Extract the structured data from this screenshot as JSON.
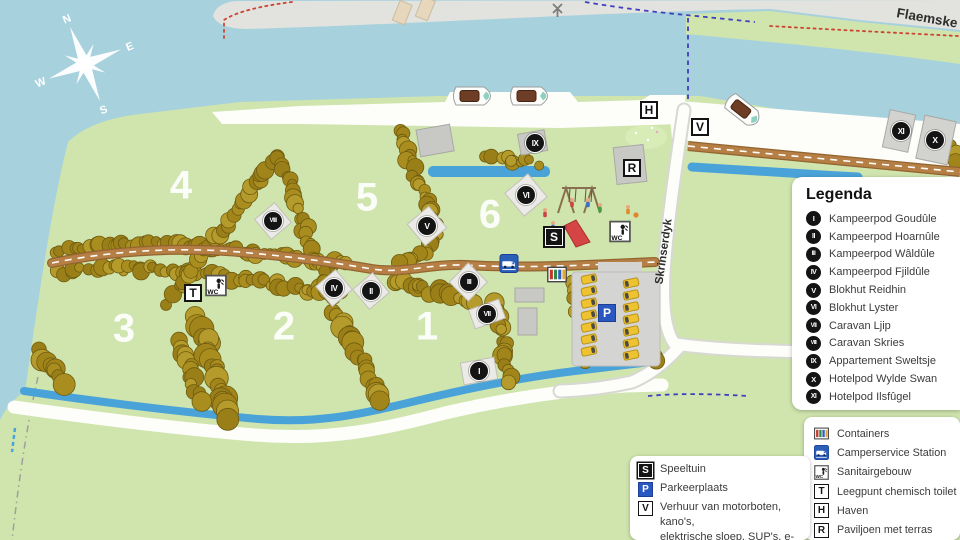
{
  "map": {
    "compass": {
      "n": "N",
      "e": "E",
      "s": "S",
      "w": "W"
    },
    "road_labels": [
      {
        "text": "Flaemske",
        "x": 896,
        "y": 17,
        "rot": 10,
        "anchor": "start",
        "size": 13.5
      },
      {
        "text": "Skrinserdyk",
        "x": 667,
        "y": 252,
        "rot": -82,
        "anchor": "middle",
        "size": 11.5
      }
    ],
    "zones": [
      {
        "label": "4",
        "x": 181,
        "y": 186
      },
      {
        "label": "5",
        "x": 367,
        "y": 198
      },
      {
        "label": "6",
        "x": 490,
        "y": 215
      },
      {
        "label": "3",
        "x": 124,
        "y": 329
      },
      {
        "label": "2",
        "x": 284,
        "y": 327
      },
      {
        "label": "1",
        "x": 427,
        "y": 327
      }
    ],
    "circle_markers": [
      {
        "numeral": "I",
        "x": 479,
        "y": 371
      },
      {
        "numeral": "II",
        "x": 371,
        "y": 291
      },
      {
        "numeral": "III",
        "x": 469,
        "y": 282
      },
      {
        "numeral": "IV",
        "x": 334,
        "y": 288
      },
      {
        "numeral": "V",
        "x": 427,
        "y": 226
      },
      {
        "numeral": "VI",
        "x": 526,
        "y": 195
      },
      {
        "numeral": "VII",
        "x": 487,
        "y": 314
      },
      {
        "numeral": "VIII",
        "x": 273,
        "y": 221
      },
      {
        "numeral": "IX",
        "x": 535,
        "y": 143
      },
      {
        "numeral": "X",
        "x": 935,
        "y": 140
      },
      {
        "numeral": "XI",
        "x": 901,
        "y": 131
      }
    ],
    "square_markers": [
      {
        "letter": "T",
        "x": 193,
        "y": 293,
        "style": "white"
      },
      {
        "letter": "S",
        "x": 554,
        "y": 237,
        "style": "black"
      },
      {
        "letter": "P",
        "x": 607,
        "y": 313,
        "style": "blue"
      },
      {
        "letter": "V",
        "x": 700,
        "y": 127,
        "style": "white"
      },
      {
        "letter": "H",
        "x": 649,
        "y": 110,
        "style": "white"
      },
      {
        "letter": "R",
        "x": 632,
        "y": 168,
        "style": "white"
      }
    ],
    "facility_icons": [
      {
        "icon": "sanitair",
        "x": 216,
        "y": 288,
        "size": 22
      },
      {
        "icon": "sanitair",
        "x": 620,
        "y": 234,
        "size": 22
      },
      {
        "icon": "camperservice",
        "x": 509,
        "y": 266,
        "size": 19
      },
      {
        "icon": "containers",
        "x": 557,
        "y": 277,
        "size": 20
      }
    ]
  },
  "icons": {
    "wc_label": "WC"
  },
  "legend": {
    "title": "Legenda",
    "accommodations": [
      {
        "num": "I",
        "label": "Kampeerpod Goudûle"
      },
      {
        "num": "II",
        "label": "Kampeerpod Hoarnûle"
      },
      {
        "num": "III",
        "label": "Kampeerpod Wâldûle"
      },
      {
        "num": "IV",
        "label": "Kampeerpod Fjildûle"
      },
      {
        "num": "V",
        "label": "Blokhut Reidhin"
      },
      {
        "num": "VI",
        "label": "Blokhut Lyster"
      },
      {
        "num": "VII",
        "label": "Caravan Ljip"
      },
      {
        "num": "VIII",
        "label": "Caravan Skries"
      },
      {
        "num": "IX",
        "label": "Appartement Sweltsje"
      },
      {
        "num": "X",
        "label": "Hotelpod Wylde Swan"
      },
      {
        "num": "XI",
        "label": "Hotelpod Ilsfûgel"
      }
    ]
  },
  "facilities_legend": [
    {
      "icon": "containers",
      "label": "Containers"
    },
    {
      "icon": "camperservice",
      "label": "Camperservice Station"
    },
    {
      "icon": "sanitair",
      "label": "Sanitairgebouw"
    },
    {
      "icon": "T",
      "style": "white",
      "label": "Leegpunt chemisch toilet"
    },
    {
      "icon": "H",
      "style": "white",
      "label": "Haven"
    },
    {
      "icon": "R",
      "style": "white",
      "label": "Paviljoen met terras"
    }
  ],
  "amenities_legend": [
    {
      "icon": "S",
      "style": "black",
      "label": "Speeltuin"
    },
    {
      "icon": "P",
      "style": "blue",
      "label": "Parkeerplaats"
    },
    {
      "icon": "V",
      "style": "white",
      "label": "Verhuur van motorboten, kano's,",
      "label2": "elektrische sloep, SUP's, e-bikes"
    }
  ],
  "colors": {
    "water": "#a7d1dd",
    "land": "#cfe5ad",
    "stream": "#4aa3d8",
    "road_brown": "#b57f45",
    "tree": "#a98e1f",
    "marker_black": "#141414",
    "parking_blue": "#2a58c0"
  }
}
